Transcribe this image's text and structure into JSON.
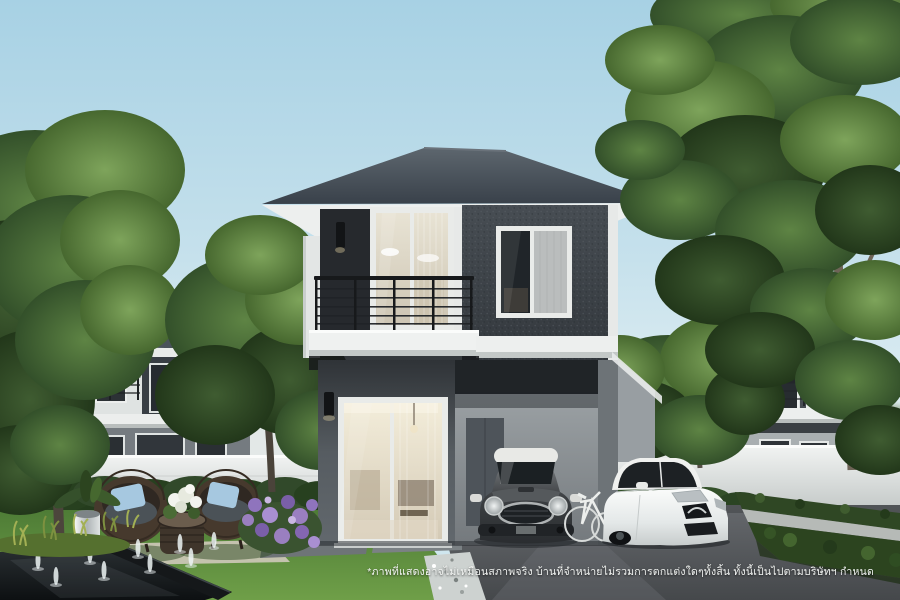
{
  "scene": {
    "description": "3D real-estate rendering: modern two-storey detached house with balcony, ground-floor carport with a grey hatchback, a white sedan and a bicycle, landscaped front garden with wicker chairs, fountain pond, hedges, neighbouring houses and large trees"
  },
  "disclaimer": {
    "text": "*ภาพที่แสดงอาจไม่เหมือนสภาพจริง บ้านที่จำหน่ายไม่รวมการตกแต่งใดๆทั้งสิ้น ทั้งนี้เป็นไปตามบริษัทฯ กำหนด"
  },
  "colors": {
    "sky_top": "#a7d1e4",
    "sky_horizon": "#e9f3f5",
    "roof": "#454e56",
    "facade_dark": "#3d4247",
    "accent_panel": "#26292d",
    "trim_white": "#eef0ef",
    "lawn_green": "#5d8c3e",
    "foliage_green": "#4d7336",
    "hedge_green": "#2c441f",
    "driveway_grey": "#54585c",
    "pond_black": "#14171a",
    "cushion_blue": "#a6c8e0",
    "wicker_brown": "#46392d",
    "mini_car_grey": "#3c3f42",
    "sedan_white": "#f0f1ef"
  }
}
